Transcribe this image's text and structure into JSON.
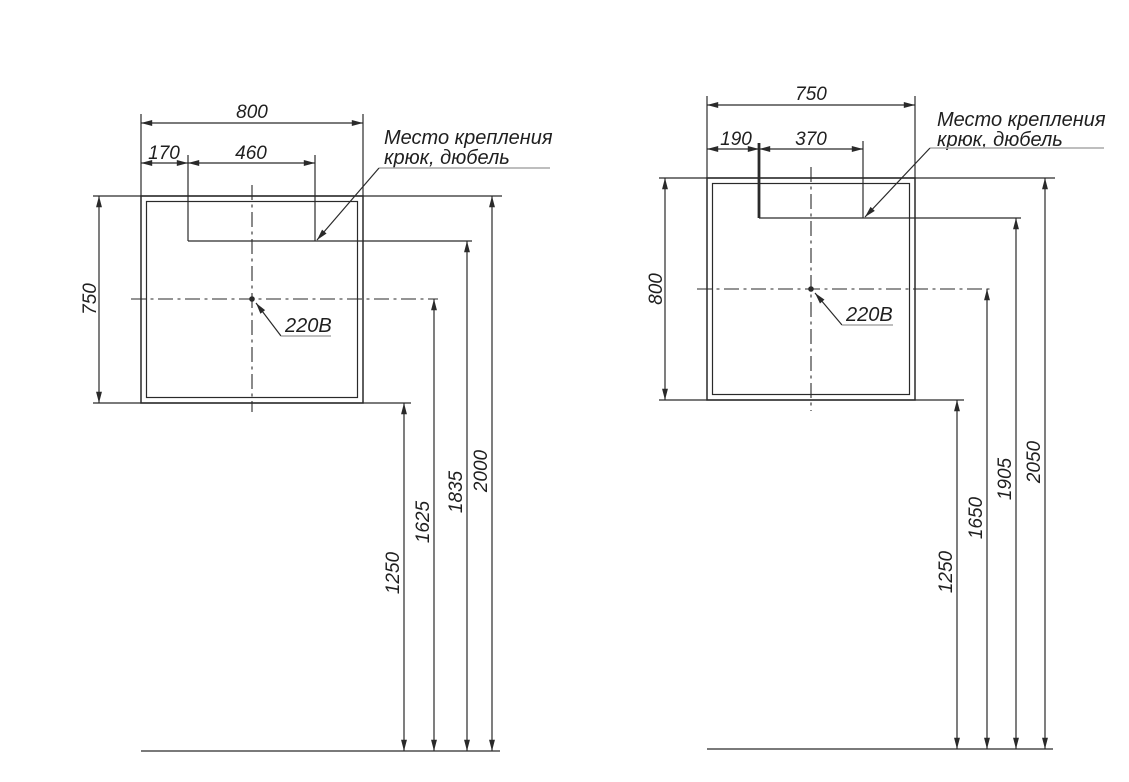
{
  "colors": {
    "line": "#2a2a2a",
    "text": "#1f1f1f",
    "leader_underline": "#a9a9a9",
    "background": "#ffffff"
  },
  "drawings": [
    {
      "width": "800",
      "hook_offset": "170",
      "hook_span": "460",
      "height": "750",
      "mount_note_line1": "Место крепления",
      "mount_note_line2": "крюк, дюбель",
      "power_label": "220В",
      "floor_to_bottom": "1250",
      "floor_to_outlet": "1625",
      "floor_to_hook": "1835",
      "floor_to_top": "2000"
    },
    {
      "width": "750",
      "hook_offset": "190",
      "hook_span": "370",
      "height": "800",
      "mount_note_line1": "Место крепления",
      "mount_note_line2": "крюк, дюбель",
      "power_label": "220В",
      "floor_to_bottom": "1250",
      "floor_to_outlet": "1650",
      "floor_to_hook": "1905",
      "floor_to_top": "2050"
    }
  ]
}
